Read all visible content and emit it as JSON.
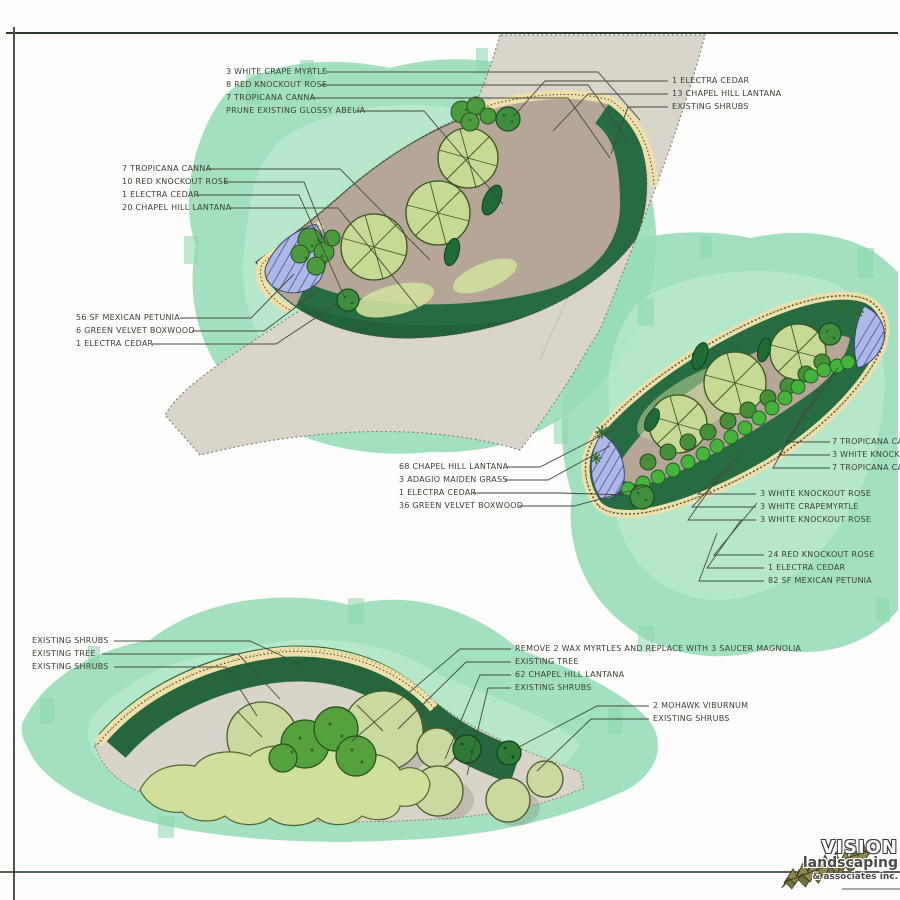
{
  "annotations": {
    "top_left": {
      "items": [
        "3 WHITE CRAPE MYRTLE",
        "8 RED KNOCKOUT ROSE",
        "7 TROPICANA CANNA",
        "PRUNE EXISTING GLOSSY ABELIA"
      ]
    },
    "top_right": {
      "items": [
        "1 ELECTRA CEDAR",
        "13 CHAPEL HILL LANTANA",
        "EXISTING SHRUBS"
      ]
    },
    "upper_left": {
      "items": [
        "7 TROPICANA CANNA",
        "10 RED KNOCKOUT ROSE",
        "1 ELECTRA CEDAR",
        "20 CHAPEL HILL LANTANA"
      ]
    },
    "mid_left": {
      "items": [
        "56 SF MEXICAN PETUNIA",
        "6 GREEN VELVET BOXWOOD",
        "1 ELECTRA CEDAR"
      ]
    },
    "mid_center": {
      "items": [
        "68 CHAPEL HILL LANTANA",
        "3 ADAGIO MAIDEN GRASS",
        "1 ELECTRA CEDAR",
        "36 GREEN VELVET BOXWOOD"
      ]
    },
    "right_edge": {
      "items": [
        "7 TROPICANA CANNA",
        "3 WHITE KNOCKOUT",
        "7 TROPICANA CANNA"
      ]
    },
    "right_lower": {
      "items": [
        "3 WHITE KNOCKOUT ROSE",
        "3 WHITE CRAPEMYRTLE",
        "3 WHITE KNOCKOUT ROSE"
      ]
    },
    "right_bottom": {
      "items": [
        "24 RED KNOCKOUT ROSE",
        "1 ELECTRA CEDAR",
        "82 SF MEXICAN PETUNIA"
      ]
    },
    "bottom_left": {
      "items": [
        "EXISTING SHRUBS",
        "EXISTING TREE",
        "EXISTING SHRUBS"
      ]
    },
    "bottom_center": {
      "items": [
        "REMOVE 2 WAX MYRTLES AND REPLACE WITH 3 SAUCER MAGNOLIA",
        "EXISTING TREE",
        "62 CHAPEL HILL LANTANA",
        "EXISTING SHRUBS"
      ]
    },
    "bottom_right": {
      "items": [
        "2 MOHAWK VIBURNUM",
        "EXISTING SHRUBS"
      ]
    }
  },
  "logo": {
    "name": "VISION",
    "line2": "landscaping",
    "line3": "& associates inc."
  },
  "colors": {
    "watercolor_green": "#96dcb6",
    "watercolor_light": "#c8eed8",
    "bed_dark_green": "#266b41",
    "canopy_light_green": "#c6d995",
    "hedge_bright_green": "#46b33c",
    "edging_tan": "#efe0aa",
    "petunia_blue": "#aeb9e6",
    "path_gray": "#d9d5cb",
    "mulch_brown": "#b5a698",
    "ink": "#3b4134"
  }
}
